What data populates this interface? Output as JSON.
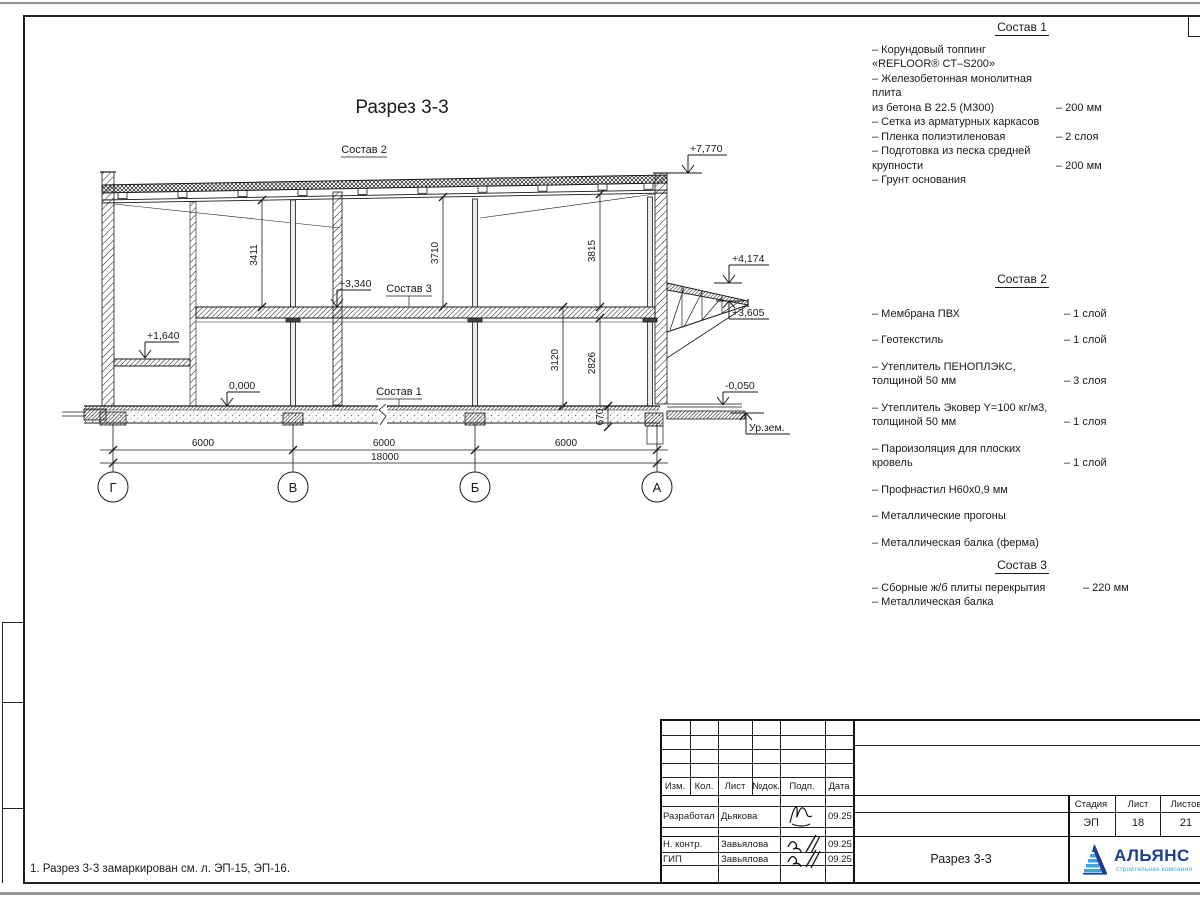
{
  "drawing": {
    "title": "Разрез 3-3",
    "callouts": {
      "c1": "Состав 1",
      "c2": "Состав 2",
      "c3": "Состав 3"
    },
    "levels": {
      "roof": "+7,770",
      "canopy_top": "+4,174",
      "canopy_edge": "+3,605",
      "floor2": "+3,340",
      "mezzanine": "+1,640",
      "zero": "0,000",
      "apron": "-0,050",
      "ground": "Ур.зем."
    },
    "dims_v": {
      "d1": "3411",
      "d2": "3710",
      "d3": "3815",
      "d4": "3120",
      "d5": "2826",
      "d6": "670"
    },
    "dims_h": {
      "bay1": "6000",
      "bay2": "6000",
      "bay3": "6000",
      "total": "18000"
    },
    "axes": [
      "Г",
      "В",
      "Б",
      "А"
    ]
  },
  "specs": [
    {
      "title": "Состав 1",
      "items": [
        {
          "n": "– Корундовый топпинг «REFLOOR® CT–S200»",
          "q": ""
        },
        {
          "n": "– Железобетонная монолитная плита\nиз бетона В 22.5 (М300)",
          "q": "– 200 мм"
        },
        {
          "n": "– Сетка из арматурных каркасов",
          "q": ""
        },
        {
          "n": "– Пленка полиэтиленовая",
          "q": "– 2 слоя"
        },
        {
          "n": "– Подготовка из песка средней\nкрупности",
          "q": "– 200 мм"
        },
        {
          "n": "– Грунт основания",
          "q": ""
        }
      ]
    },
    {
      "title": "Состав 2",
      "items": [
        {
          "n": "– Мембрана ПВХ",
          "q": "– 1 слой"
        },
        {
          "n": "– Геотекстиль",
          "q": "– 1 слой"
        },
        {
          "n": "– Утеплитель ПЕНОПЛЭКС,\nтолщиной 50 мм",
          "q": "– 3 слоя"
        },
        {
          "n": "– Утеплитель Эковер Y=100 кг/м3,\nтолщиной 50 мм",
          "q": "– 1 слоя"
        },
        {
          "n": "– Пароизоляция для плоских кровель",
          "q": "– 1 слой"
        },
        {
          "n": "– Профнастил Н60х0,9 мм",
          "q": ""
        },
        {
          "n": "– Металлические прогоны",
          "q": ""
        },
        {
          "n": "– Металлическая балка (ферма)",
          "q": ""
        }
      ]
    },
    {
      "title": "Состав 3",
      "items": [
        {
          "n": "– Сборные ж/б плиты перекрытия",
          "q": "– 220 мм"
        },
        {
          "n": "– Металлическая балка",
          "q": ""
        }
      ]
    }
  ],
  "note": "1. Разрез 3-3 замаркирован см. л. ЭП-15, ЭП-16.",
  "titleblock": {
    "header": [
      "Изм.",
      "Кол.",
      "Лист",
      "№док.",
      "Подп.",
      "Дата"
    ],
    "rows": [
      {
        "role": "Разработал",
        "name": "Дьякова",
        "date": "09.25"
      },
      {
        "role": "Н. контр.",
        "name": "Завьялова",
        "date": "09.25"
      },
      {
        "role": "ГИП",
        "name": "Завьялова",
        "date": "09.25"
      }
    ],
    "doc_title": "Разрез 3-3",
    "stage_label": "Стадия",
    "sheet_label": "Лист",
    "sheets_label": "Листов",
    "stage": "ЭП",
    "sheet": "18",
    "sheets": "21",
    "logo": {
      "name": "АЛЬЯНС",
      "subtitle": "строительная компания",
      "dark": "#1d3e94",
      "light": "#3fa3dc"
    }
  }
}
